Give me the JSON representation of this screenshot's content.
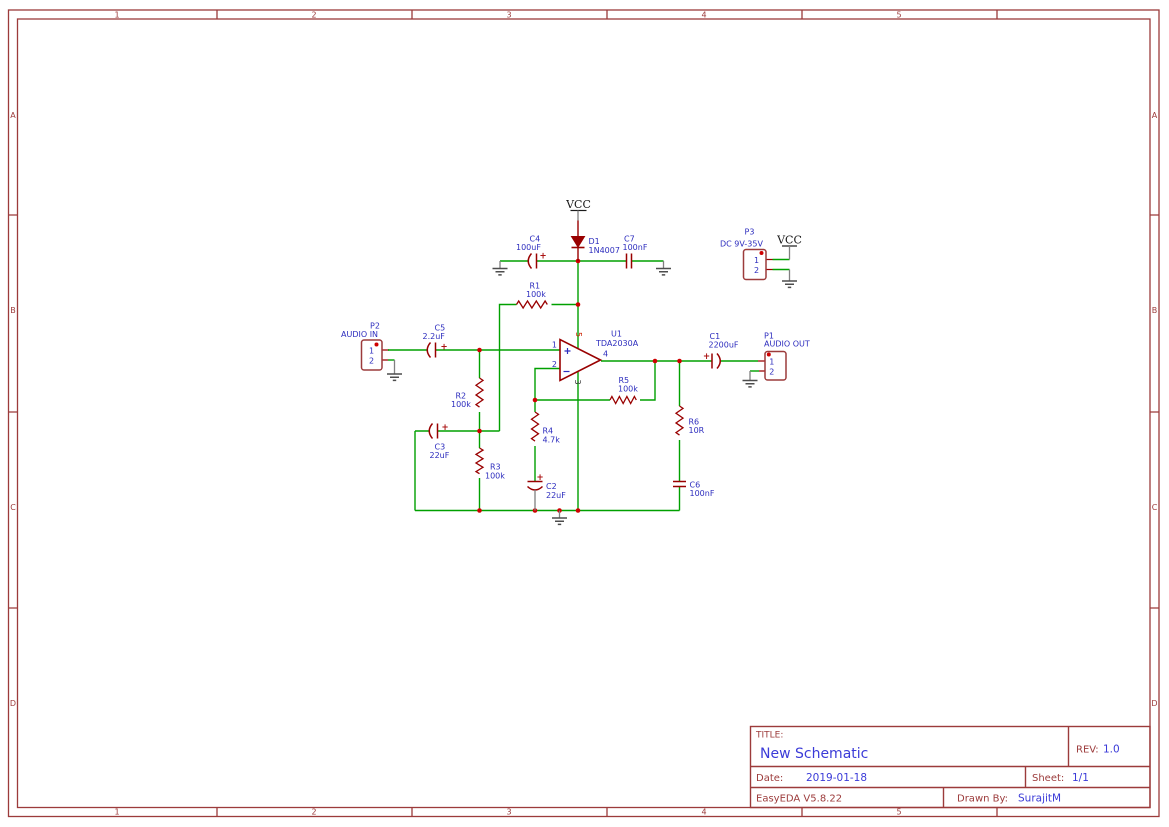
{
  "frame": {
    "columns": [
      "1",
      "2",
      "3",
      "4",
      "5"
    ],
    "rows": [
      "A",
      "B",
      "C",
      "D"
    ]
  },
  "title_block": {
    "title_label": "TITLE:",
    "title": "New Schematic",
    "rev_label": "REV:",
    "rev": "1.0",
    "date_label": "Date:",
    "date": "2019-01-18",
    "sheet_label": "Sheet:",
    "sheet": "1/1",
    "software": "EasyEDA V5.8.22",
    "drawn_by_label": "Drawn By:",
    "drawn_by": "SurajitM"
  },
  "flags": {
    "vcc": "VCC"
  },
  "opamp_pins": {
    "in_plus": "1",
    "in_minus": "2",
    "out": "4",
    "vcc_pin": "5",
    "gnd_pin": "3",
    "plus_sign": "+",
    "minus_sign": "-"
  },
  "polarity": {
    "plus": "+"
  },
  "components": {
    "U1": {
      "ref": "U1",
      "value": "TDA2030A"
    },
    "R1": {
      "ref": "R1",
      "value": "100k"
    },
    "R2": {
      "ref": "R2",
      "value": "100k"
    },
    "R3": {
      "ref": "R3",
      "value": "100k"
    },
    "R4": {
      "ref": "R4",
      "value": "4.7k"
    },
    "R5": {
      "ref": "R5",
      "value": "100k"
    },
    "R6": {
      "ref": "R6",
      "value": "10R"
    },
    "C1": {
      "ref": "C1",
      "value": "2200uF"
    },
    "C2": {
      "ref": "C2",
      "value": "22uF"
    },
    "C3": {
      "ref": "C3",
      "value": "22uF"
    },
    "C4": {
      "ref": "C4",
      "value": "100uF"
    },
    "C5": {
      "ref": "C5",
      "value": "2.2uF"
    },
    "C6": {
      "ref": "C6",
      "value": "100nF"
    },
    "C7": {
      "ref": "C7",
      "value": "100nF"
    },
    "D1": {
      "ref": "D1",
      "value": "1N4007"
    },
    "P1": {
      "ref": "P1",
      "value": "AUDIO OUT",
      "pin1": "1",
      "pin2": "2"
    },
    "P2": {
      "ref": "P2",
      "value": "AUDIO IN",
      "pin1": "1",
      "pin2": "2"
    },
    "P3": {
      "ref": "P3",
      "value": "DC 9V-35V",
      "pin1": "1",
      "pin2": "2"
    }
  },
  "colors": {
    "wire": "#00a000",
    "component": "#990000",
    "connector_box": "#9c3b3b",
    "frame": "#9c3b3b",
    "label": "#2d2dbe",
    "title_value": "#3b3bd8",
    "junction": "#cf0000",
    "ground": "#808080"
  }
}
